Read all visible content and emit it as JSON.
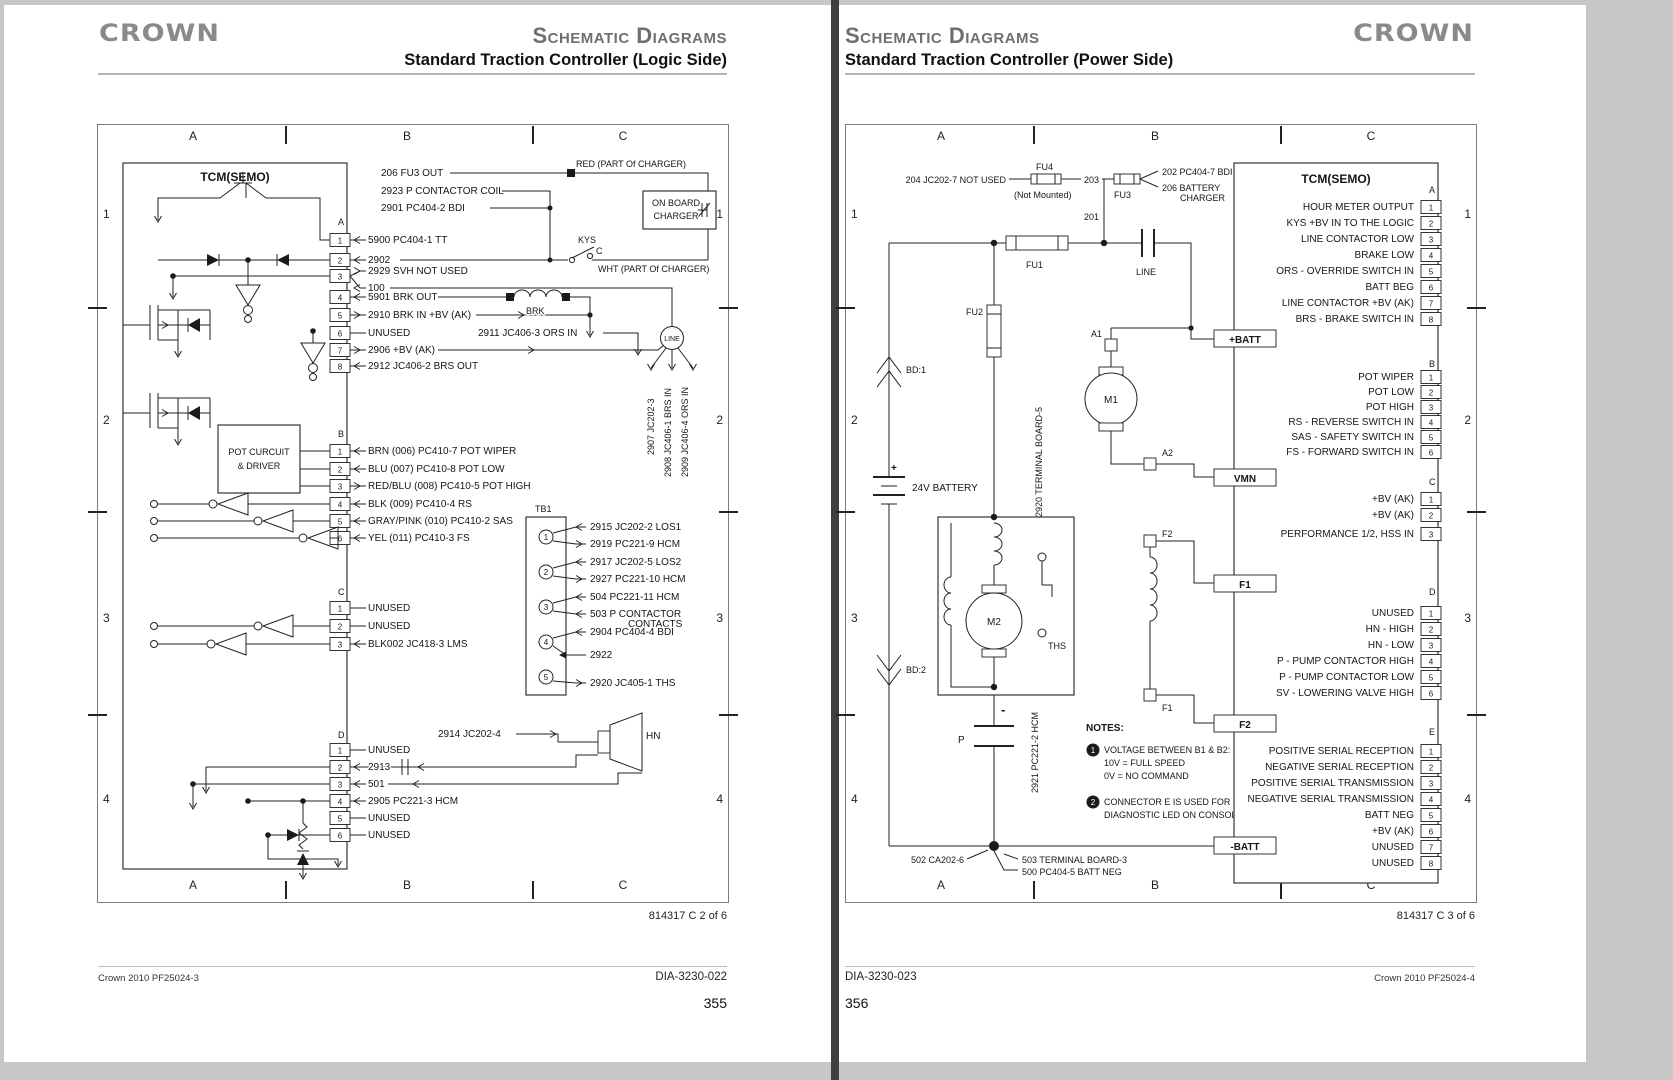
{
  "lp": {
    "brand": "CROWN",
    "title": "Schematic Diagrams",
    "subtitle": "Standard Traction Controller (Logic Side)",
    "cols": [
      "A",
      "B",
      "C"
    ],
    "rows": [
      "1",
      "2",
      "3",
      "4"
    ],
    "tcm": "TCM(SEMO)",
    "top": {
      "fu3out": "206 FU3 OUT",
      "pcoil": "2923 P CONTACTOR COIL",
      "bdi": "2901 PC404-2 BDI",
      "red": "RED (PART Of CHARGER)",
      "ob1": "ON BOARD",
      "ob2": "CHARGER",
      "kys": "KYS",
      "kc": "C",
      "wht": "WHT (PART Of CHARGER)",
      "brk": "BRK",
      "line": "LINE",
      "orsin": "2911 JC406-3 ORS IN",
      "hundred": "100",
      "v1": "2907 JC202-3",
      "v2": "2908 JC406-1 BRS IN",
      "v3": "2909 JC406-4 ORS IN"
    },
    "connA": {
      "label": "A",
      "pins": [
        {
          "n": "1",
          "t": "5900 PC404-1 TT"
        },
        {
          "n": "2",
          "t": "2902"
        },
        {
          "n": "3",
          "t": "2929 SVH NOT USED"
        },
        {
          "n": "4",
          "t": "5901 BRK OUT"
        },
        {
          "n": "5",
          "t": "2910 BRK IN +BV (AK)"
        },
        {
          "n": "6",
          "t": "UNUSED"
        },
        {
          "n": "7",
          "t": "2906 +BV (AK)"
        },
        {
          "n": "8",
          "t": "2912 JC406-2 BRS OUT"
        }
      ]
    },
    "connB": {
      "label": "B",
      "pins": [
        {
          "n": "1",
          "t": "BRN (006) PC410-7 POT WIPER"
        },
        {
          "n": "2",
          "t": "BLU (007) PC410-8 POT LOW"
        },
        {
          "n": "3",
          "t": "RED/BLU (008) PC410-5 POT HIGH"
        },
        {
          "n": "4",
          "t": "BLK (009) PC410-4 RS"
        },
        {
          "n": "5",
          "t": "GRAY/PINK (010) PC410-2 SAS"
        },
        {
          "n": "6",
          "t": "YEL (011) PC410-3 FS"
        }
      ]
    },
    "pot1": "POT CURCUIT",
    "pot2": "& DRIVER",
    "connC": {
      "label": "C",
      "pins": [
        {
          "n": "1",
          "t": "UNUSED"
        },
        {
          "n": "2",
          "t": "UNUSED"
        },
        {
          "n": "3",
          "t": "BLK002 JC418-3 LMS"
        }
      ]
    },
    "tb1": {
      "label": "TB1",
      "nums": [
        "1",
        "2",
        "3",
        "4",
        "5"
      ],
      "t1": "2915 JC202-2 LOS1",
      "t2": "2919 PC221-9 HCM",
      "t3": "2917 JC202-5 LOS2",
      "t4": "2927 PC221-10 HCM",
      "t5": "504 PC221-11 HCM",
      "t6": "503 P CONTACTOR",
      "t7": "CONTACTS",
      "t8": "2904 PC404-4 BDI",
      "t9": "2922",
      "t10": "2920 JC405-1 THS"
    },
    "connD": {
      "label": "D",
      "pins": [
        {
          "n": "1",
          "t": "UNUSED"
        },
        {
          "n": "2",
          "t": "2913"
        },
        {
          "n": "3",
          "t": "501"
        },
        {
          "n": "4",
          "t": "2905 PC221-3 HCM"
        },
        {
          "n": "5",
          "t": "UNUSED"
        },
        {
          "n": "6",
          "t": "UNUSED"
        }
      ]
    },
    "d_top": "2914 JC202-4",
    "hn": "HN",
    "doc": "814317 C 2 of 6",
    "foot_l": "Crown 2010 PF25024-3",
    "foot_r": "DIA-3230-022",
    "page": "355"
  },
  "rp": {
    "brand": "CROWN",
    "title": "Schematic Diagrams",
    "subtitle": "Standard Traction Controller (Power Side)",
    "cols": [
      "A",
      "B",
      "C"
    ],
    "rows": [
      "1",
      "2",
      "3",
      "4"
    ],
    "tcm": "TCM(SEMO)",
    "edge": {
      "pbatt": "+BATT",
      "vmn": "VMN",
      "f1": "F1",
      "f2": "F2",
      "nbatt": "-BATT"
    },
    "connA": {
      "label": "A",
      "pins": [
        {
          "n": "1",
          "t": "HOUR METER OUTPUT"
        },
        {
          "n": "2",
          "t": "KYS +BV IN TO THE LOGIC"
        },
        {
          "n": "3",
          "t": "LINE CONTACTOR LOW"
        },
        {
          "n": "4",
          "t": "BRAKE LOW"
        },
        {
          "n": "5",
          "t": "ORS - OVERRIDE SWITCH IN"
        },
        {
          "n": "6",
          "t": "BATT BEG"
        },
        {
          "n": "7",
          "t": "LINE CONTACTOR +BV (AK)"
        },
        {
          "n": "8",
          "t": "BRS - BRAKE SWITCH IN"
        }
      ]
    },
    "connB": {
      "label": "B",
      "pins": [
        {
          "n": "1",
          "t": "POT WIPER"
        },
        {
          "n": "2",
          "t": "POT LOW"
        },
        {
          "n": "3",
          "t": "POT HIGH"
        },
        {
          "n": "4",
          "t": "RS - REVERSE SWITCH IN"
        },
        {
          "n": "5",
          "t": "SAS - SAFETY SWITCH IN"
        },
        {
          "n": "6",
          "t": "FS - FORWARD SWITCH IN"
        }
      ]
    },
    "connC": {
      "label": "C",
      "pins": [
        {
          "n": "1",
          "t": "+BV (AK)"
        },
        {
          "n": "2",
          "t": "+BV (AK)"
        },
        {
          "n": "3",
          "t": "PERFORMANCE 1/2, HSS IN"
        }
      ]
    },
    "connD": {
      "label": "D",
      "pins": [
        {
          "n": "1",
          "t": "UNUSED"
        },
        {
          "n": "2",
          "t": "HN - HIGH"
        },
        {
          "n": "3",
          "t": "HN - LOW"
        },
        {
          "n": "4",
          "t": "P - PUMP CONTACTOR HIGH"
        },
        {
          "n": "5",
          "t": "P - PUMP CONTACTOR LOW"
        },
        {
          "n": "6",
          "t": "SV - LOWERING VALVE HIGH"
        }
      ]
    },
    "connE": {
      "label": "E",
      "pins": [
        {
          "n": "1",
          "t": "POSITIVE SERIAL RECEPTION"
        },
        {
          "n": "2",
          "t": "NEGATIVE SERIAL RECEPTION"
        },
        {
          "n": "3",
          "t": "POSITIVE SERIAL TRANSMISSION"
        },
        {
          "n": "4",
          "t": "NEGATIVE SERIAL TRANSMISSION"
        },
        {
          "n": "5",
          "t": "BATT NEG"
        },
        {
          "n": "6",
          "t": "+BV (AK)"
        },
        {
          "n": "7",
          "t": "UNUSED"
        },
        {
          "n": "8",
          "t": "UNUSED"
        }
      ]
    },
    "lab": {
      "l204": "204 JC202-7 NOT USED",
      "fu4": "FU4",
      "nm": "(Not Mounted)",
      "l203": "203",
      "fu3": "FU3",
      "l202": "202 PC404-7 BDI",
      "l206a": "206 BATTERY",
      "l206b": "CHARGER",
      "l201": "201",
      "fu1": "FU1",
      "line": "LINE",
      "fu2": "FU2",
      "bd1": "BD:1",
      "plus": "+",
      "batt": "24V BATTERY",
      "bd2": "BD:2",
      "tb5": "2920 TERMINAL BOARD-5",
      "a1": "A1",
      "m1": "M1",
      "a2": "A2",
      "f2": "F2",
      "f1": "F1",
      "m2": "M2",
      "ths": "THS",
      "minus": "-",
      "p": "P",
      "hcm": "2921 PC221-2 HCM",
      "l502": "502 CA202-6",
      "l503": "503 TERMINAL BOARD-3",
      "l500": "500 PC404-5 BATT NEG"
    },
    "notes": {
      "h": "NOTES:",
      "n1": "1",
      "n1a": "VOLTAGE BETWEEN B1 & B2:",
      "n1b": "10V = FULL SPEED",
      "n1c": "0V = NO COMMAND",
      "n2": "2",
      "n2a": "CONNECTOR E IS USED FOR",
      "n2b": "DIAGNOSTIC LED ON CONSOLE."
    },
    "doc": "814317 C 3 of 6",
    "foot_l": "DIA-3230-023",
    "foot_r": "Crown 2010 PF25024-4",
    "page": "356"
  }
}
